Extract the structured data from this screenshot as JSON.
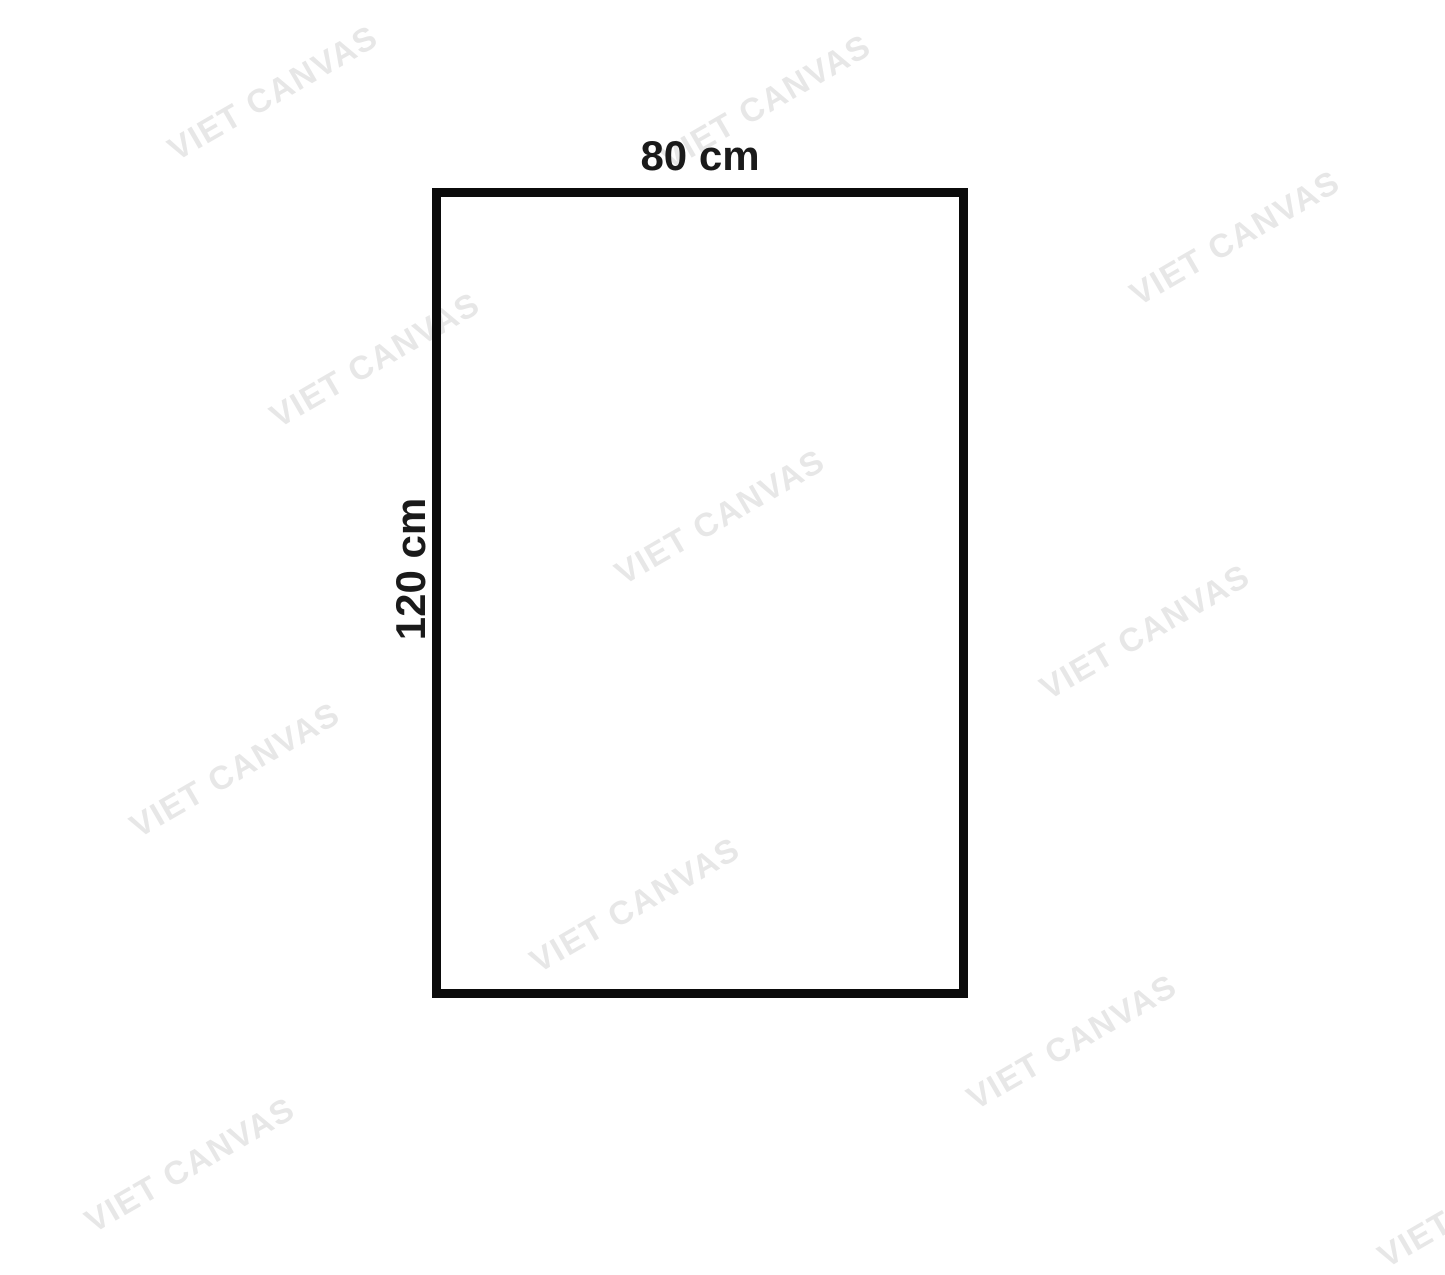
{
  "diagram": {
    "width_label": "80 cm",
    "height_label": "120 cm"
  },
  "watermark": {
    "text": "VIET CANVAS",
    "color": "#e7e7e7",
    "count": 11
  },
  "colors": {
    "background": "#ffffff",
    "rectangle_border": "#0b0b0b",
    "label_text": "#1a1a1a"
  }
}
